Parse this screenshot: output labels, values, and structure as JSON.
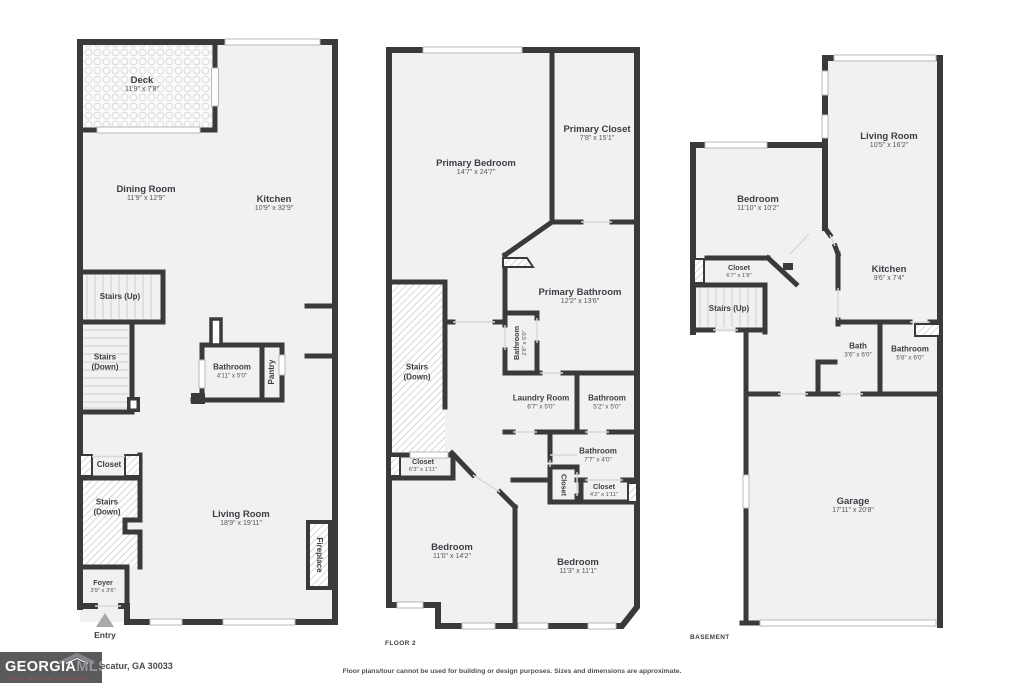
{
  "plans": {
    "floor1": {
      "rooms": {
        "deck": {
          "name": "Deck",
          "dims": "11'9\" x 7'8\""
        },
        "dining": {
          "name": "Dining Room",
          "dims": "11'9\" x 12'9\""
        },
        "kitchen": {
          "name": "Kitchen",
          "dims": "10'9\" x 32'9\""
        },
        "stairs_up": {
          "name": "Stairs (Up)"
        },
        "stairs_down_mid": {
          "name": "Stairs (Down)"
        },
        "bathroom": {
          "name": "Bathroom",
          "dims": "4'11\" x 5'0\""
        },
        "pantry": {
          "name": "Pantry"
        },
        "closet": {
          "name": "Closet"
        },
        "stairs_down_low": {
          "name": "Stairs (Down)"
        },
        "living": {
          "name": "Living Room",
          "dims": "18'9\" x 19'11\""
        },
        "fireplace": {
          "name": "Fireplace"
        },
        "foyer": {
          "name": "Foyer",
          "dims": "3'9\" x 3'6\""
        },
        "entry": {
          "name": "Entry"
        }
      }
    },
    "floor2": {
      "label": "FLOOR 2",
      "rooms": {
        "primary_bedroom": {
          "name": "Primary Bedroom",
          "dims": "14'7\" x 24'7\""
        },
        "primary_closet": {
          "name": "Primary Closet",
          "dims": "7'8\" x 15'1\""
        },
        "primary_bathroom": {
          "name": "Primary Bathroom",
          "dims": "12'2\" x 13'6\""
        },
        "bathroom_small": {
          "name": "Bathroom",
          "dims": "2'8\" x 5'0\""
        },
        "stairs_down": {
          "name": "Stairs (Down)"
        },
        "laundry": {
          "name": "Laundry Room",
          "dims": "6'7\" x 5'0\""
        },
        "bathroom_mid": {
          "name": "Bathroom",
          "dims": "5'2\" x 5'0\""
        },
        "bathroom_low": {
          "name": "Bathroom",
          "dims": "7'7\" x 4'0\""
        },
        "closet_vert": {
          "name": "Closet"
        },
        "closet_small": {
          "name": "Closet",
          "dims": "4'2\" x 1'11\""
        },
        "closet_left": {
          "name": "Closet",
          "dims": "6'3\" x 1'11\""
        },
        "bedroom_left": {
          "name": "Bedroom",
          "dims": "11'0\" x 14'2\""
        },
        "bedroom_right": {
          "name": "Bedroom",
          "dims": "11'3\" x 11'1\""
        }
      }
    },
    "basement": {
      "label": "BASEMENT",
      "rooms": {
        "living": {
          "name": "Living Room",
          "dims": "10'5\" x 16'2\""
        },
        "bedroom": {
          "name": "Bedroom",
          "dims": "11'10\" x 10'2\""
        },
        "closet": {
          "name": "Closet",
          "dims": "6'7\" x 1'8\""
        },
        "stairs_up": {
          "name": "Stairs (Up)"
        },
        "kitchen": {
          "name": "Kitchen",
          "dims": "9'6\" x 7'4\""
        },
        "bath": {
          "name": "Bath",
          "dims": "3'6\" x 6'0\""
        },
        "bathroom": {
          "name": "Bathroom",
          "dims": "5'8\" x 6'0\""
        },
        "garage": {
          "name": "Garage",
          "dims": "17'11\" x 20'8\""
        }
      }
    }
  },
  "footer": {
    "logo": {
      "brand": "GEORGIA",
      "brand2": "MLS",
      "tagline": "REAL ESTATE SERVICES"
    },
    "address": "Decatur, GA 30033",
    "disclaimer": "Floor plans/tour cannot be used for building or design purposes. Sizes and dimensions are approximate."
  },
  "colors": {
    "wall": "#3a3a3c",
    "floor": "#f1f1f1",
    "hatch": "#c6c6c6",
    "logo_bg": "#595a5c"
  }
}
